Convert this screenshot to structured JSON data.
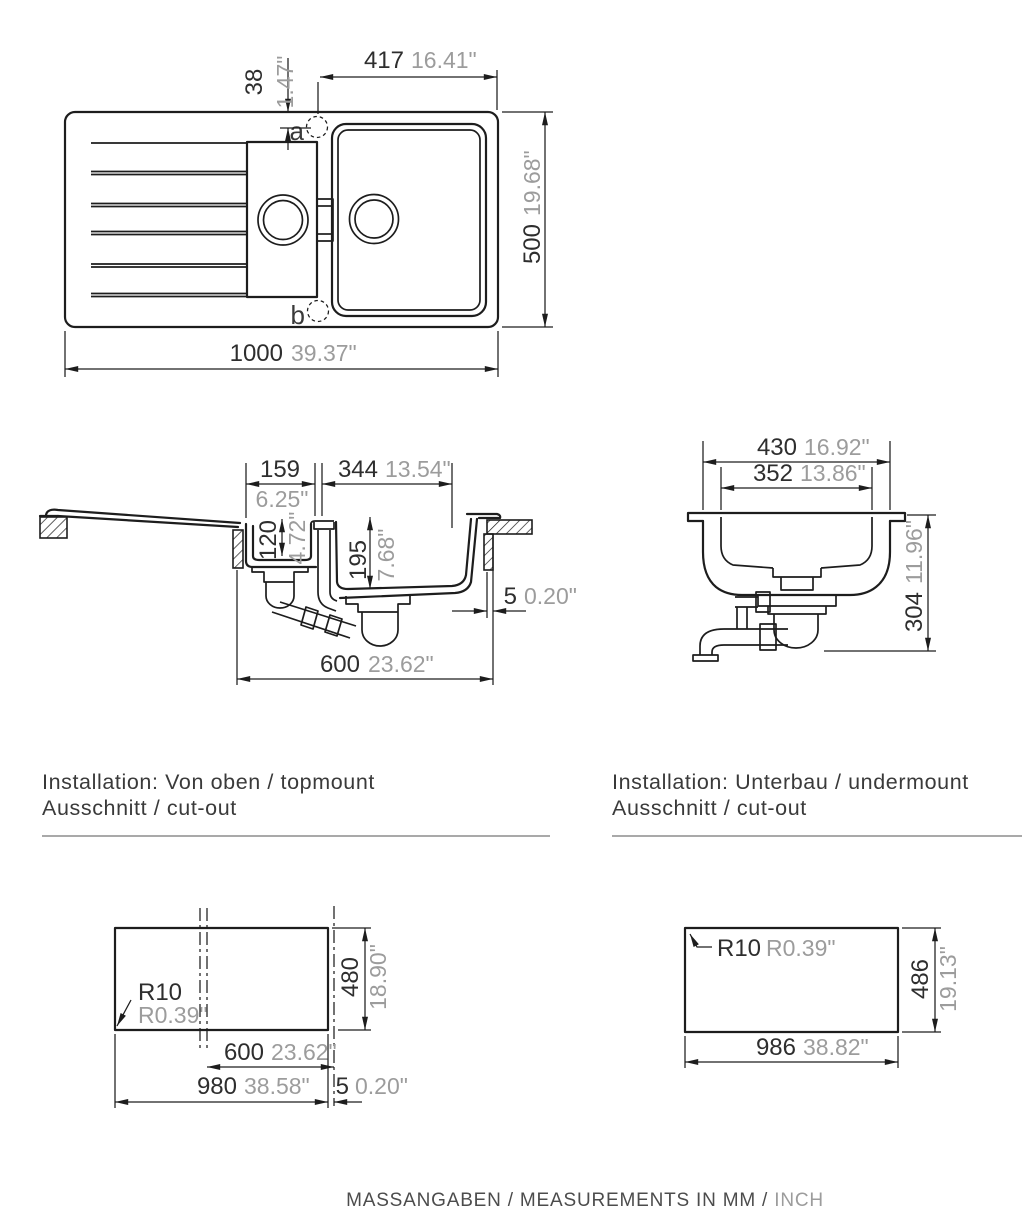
{
  "colors": {
    "line": "#1d1d1d",
    "mm_text": "#2e2e2e",
    "inch_text": "#9c9c9c",
    "rule": "#a9a9a9"
  },
  "captions": {
    "topmount": {
      "line1": "Installation: Von oben / topmount",
      "line2": "Ausschnitt / cut-out"
    },
    "undermount": {
      "line1": "Installation: Unterbau / undermount",
      "line2": "Ausschnitt / cut-out"
    }
  },
  "footer": {
    "main": "MASSANGABEN / MEASUREMENTS IN MM /",
    "inch": "INCH"
  },
  "top_view": {
    "holes": {
      "a": "a",
      "b": "b"
    },
    "dims": {
      "bowl_offset_width": {
        "mm": "417",
        "inch": "16.41\""
      },
      "hole_offset": {
        "mm": "38",
        "inch": "1.47\""
      },
      "depth": {
        "mm": "500",
        "inch": "19.68\""
      },
      "total_width": {
        "mm": "1000",
        "inch": "39.37\""
      }
    }
  },
  "side_section": {
    "dims": {
      "small_bowl_width": {
        "mm": "159",
        "inch": "6.25\""
      },
      "large_bowl_width": {
        "mm": "344",
        "inch": "13.54\""
      },
      "small_bowl_depth": {
        "mm": "120",
        "inch": "4.72\""
      },
      "large_bowl_depth": {
        "mm": "195",
        "inch": "7.68\""
      },
      "rim_gap": {
        "mm": "5",
        "inch": "0.20\""
      },
      "cutout_width": {
        "mm": "600",
        "inch": "23.62\""
      }
    }
  },
  "end_section": {
    "dims": {
      "outer_width": {
        "mm": "430",
        "inch": "16.92\""
      },
      "inner_width": {
        "mm": "352",
        "inch": "13.86\""
      },
      "height": {
        "mm": "304",
        "inch": "11.96\""
      }
    }
  },
  "cutout_topmount": {
    "radius": {
      "mm": "R10",
      "inch": "R0.39\""
    },
    "height": {
      "mm": "480",
      "inch": "18.90\""
    },
    "bowl_cutout": {
      "mm": "600",
      "inch": "23.62\""
    },
    "width": {
      "mm": "980",
      "inch": "38.58\""
    },
    "edge_gap": {
      "mm": "5",
      "inch": "0.20\""
    }
  },
  "cutout_undermount": {
    "radius": {
      "mm": "R10",
      "inch": "R0.39\""
    },
    "height": {
      "mm": "486",
      "inch": "19.13\""
    },
    "width": {
      "mm": "986",
      "inch": "38.82\""
    }
  }
}
